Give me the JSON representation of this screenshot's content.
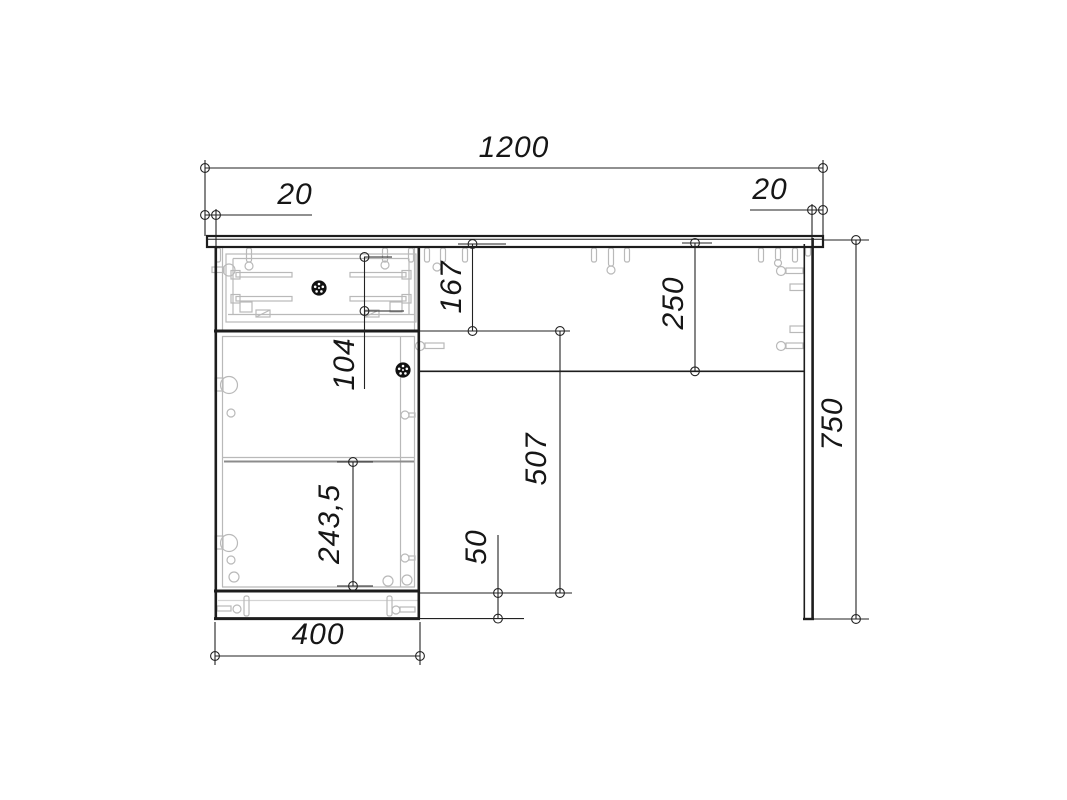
{
  "drawing": {
    "object": "desk with drawer pedestal",
    "view": "front elevation technical drawing",
    "units": "mm",
    "colors": {
      "background": "#ffffff",
      "line": "#1d1d1d",
      "hardware": "#b9b9b9",
      "dimension": "#161616"
    }
  },
  "dimensions": {
    "overall_width": "1200",
    "left_overhang": "20",
    "right_overhang": "20",
    "drawer_section_height": "167",
    "drawer_box_height": "104",
    "apron_height": "250",
    "door_section_height": "507",
    "shelf_spacing": "243,5",
    "plinth_height": "50",
    "pedestal_width": "400",
    "overall_height": "750"
  }
}
